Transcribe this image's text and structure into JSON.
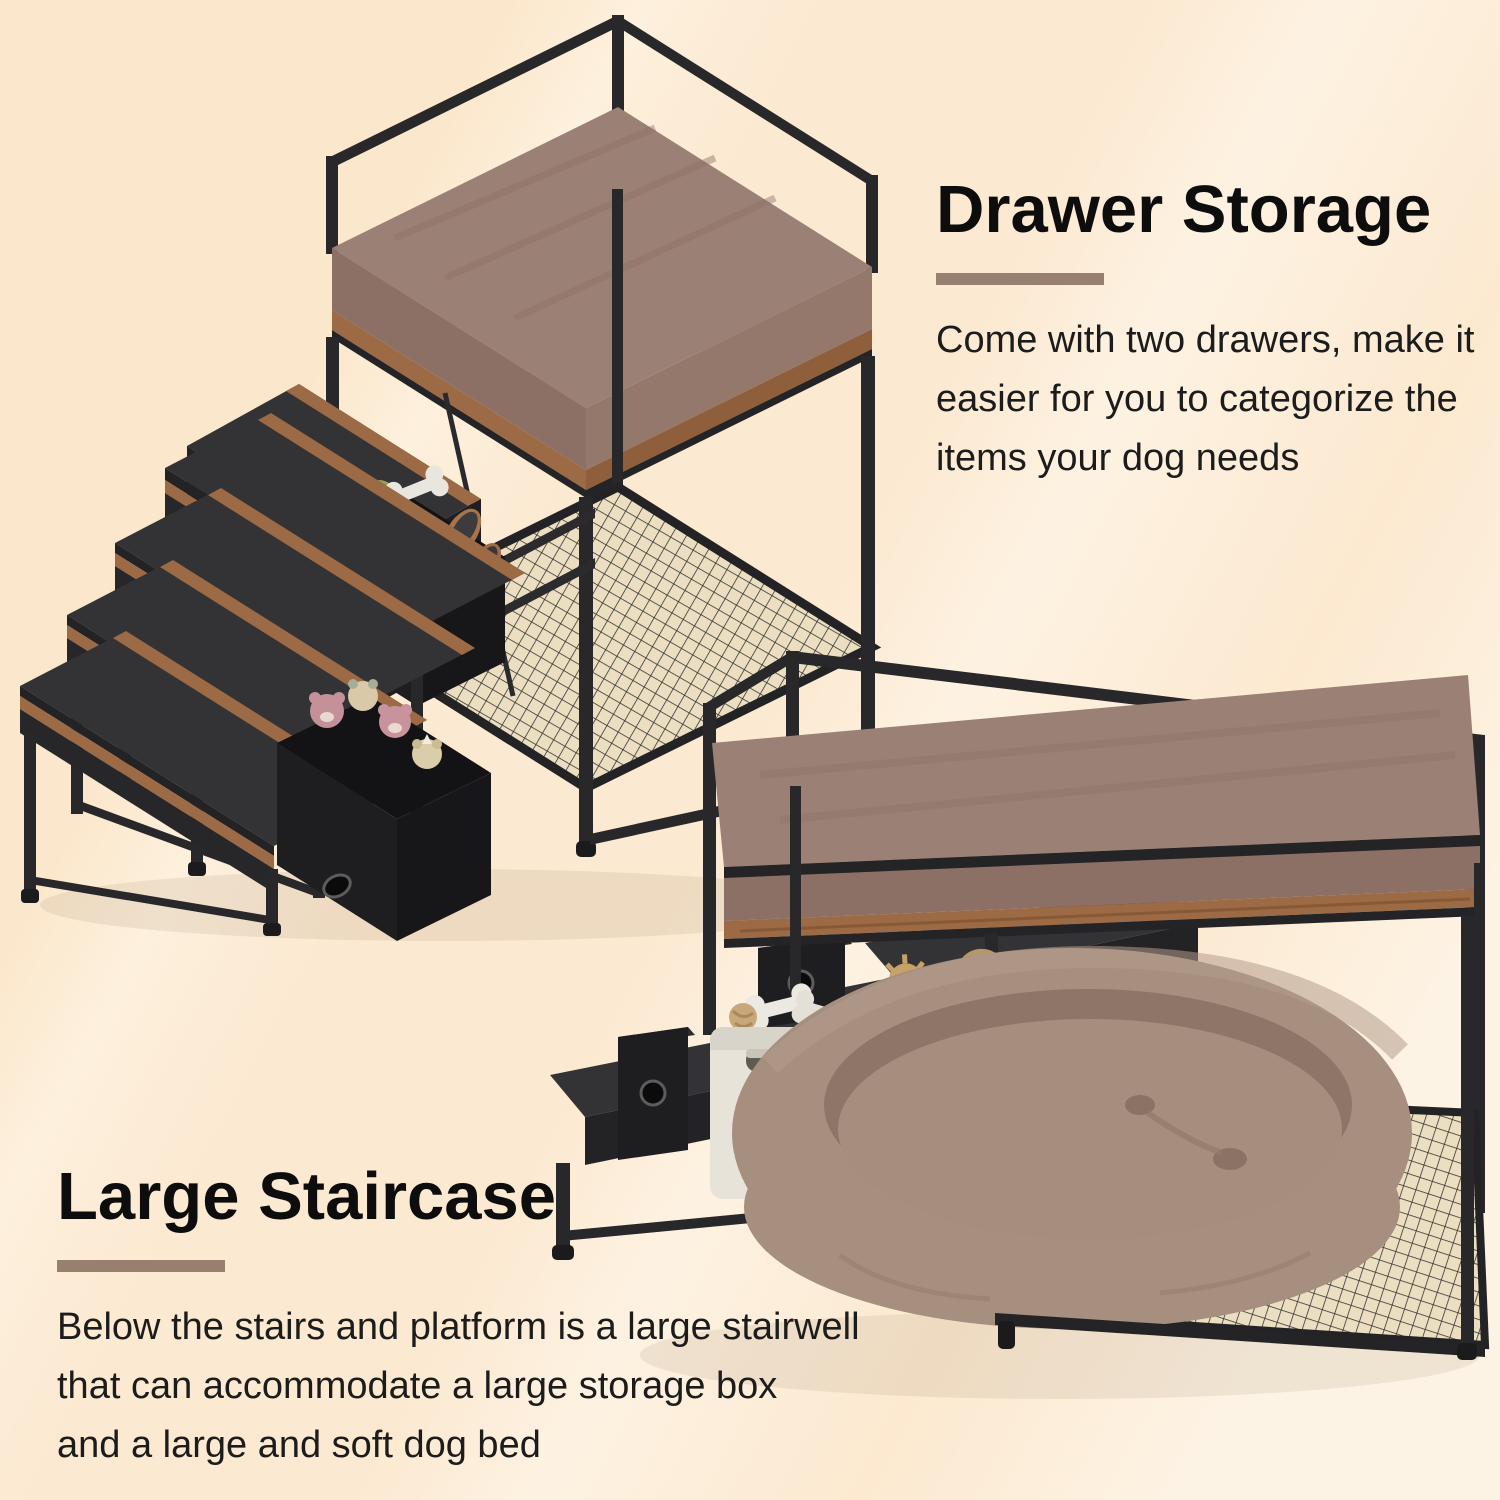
{
  "page": {
    "background_base": "#fce9d0",
    "background_sheen": "#fdf3e3",
    "accent_divider_color": "#97806f",
    "heading_color": "#0d0d0d",
    "body_text_color": "#1c1c1c"
  },
  "sections": {
    "drawer_storage": {
      "heading": "Drawer Storage",
      "body": "Come with two drawers, make it\neasier for you to categorize the\nitems your dog needs"
    },
    "large_staircase": {
      "heading": "Large Staircase",
      "body": "Below the stairs and platform is a large stairwell\nthat can accommodate a large storage box\nand a large and soft dog bed"
    }
  },
  "illustrations": {
    "iso_view_label": "Dog bed platform with five-step staircase and two pulled-out fabric drawers holding pet toys",
    "front_view_label": "Dog bed platform with plush dog bed in the stairwell, storage boxes and two closed drawers"
  },
  "product_colors": {
    "frame_black": "#28282a",
    "tread_dark": "#343436",
    "wood_accent": "#9c6a44",
    "cushion_brown": "#9b8075",
    "mesh_beige": "#ecdfc1",
    "dog_bed_taupe": "#a78f80",
    "drawer_fabric": "#1e1e20",
    "white_bin": "#e8e3d9",
    "gray_bin": "#908f8d"
  }
}
